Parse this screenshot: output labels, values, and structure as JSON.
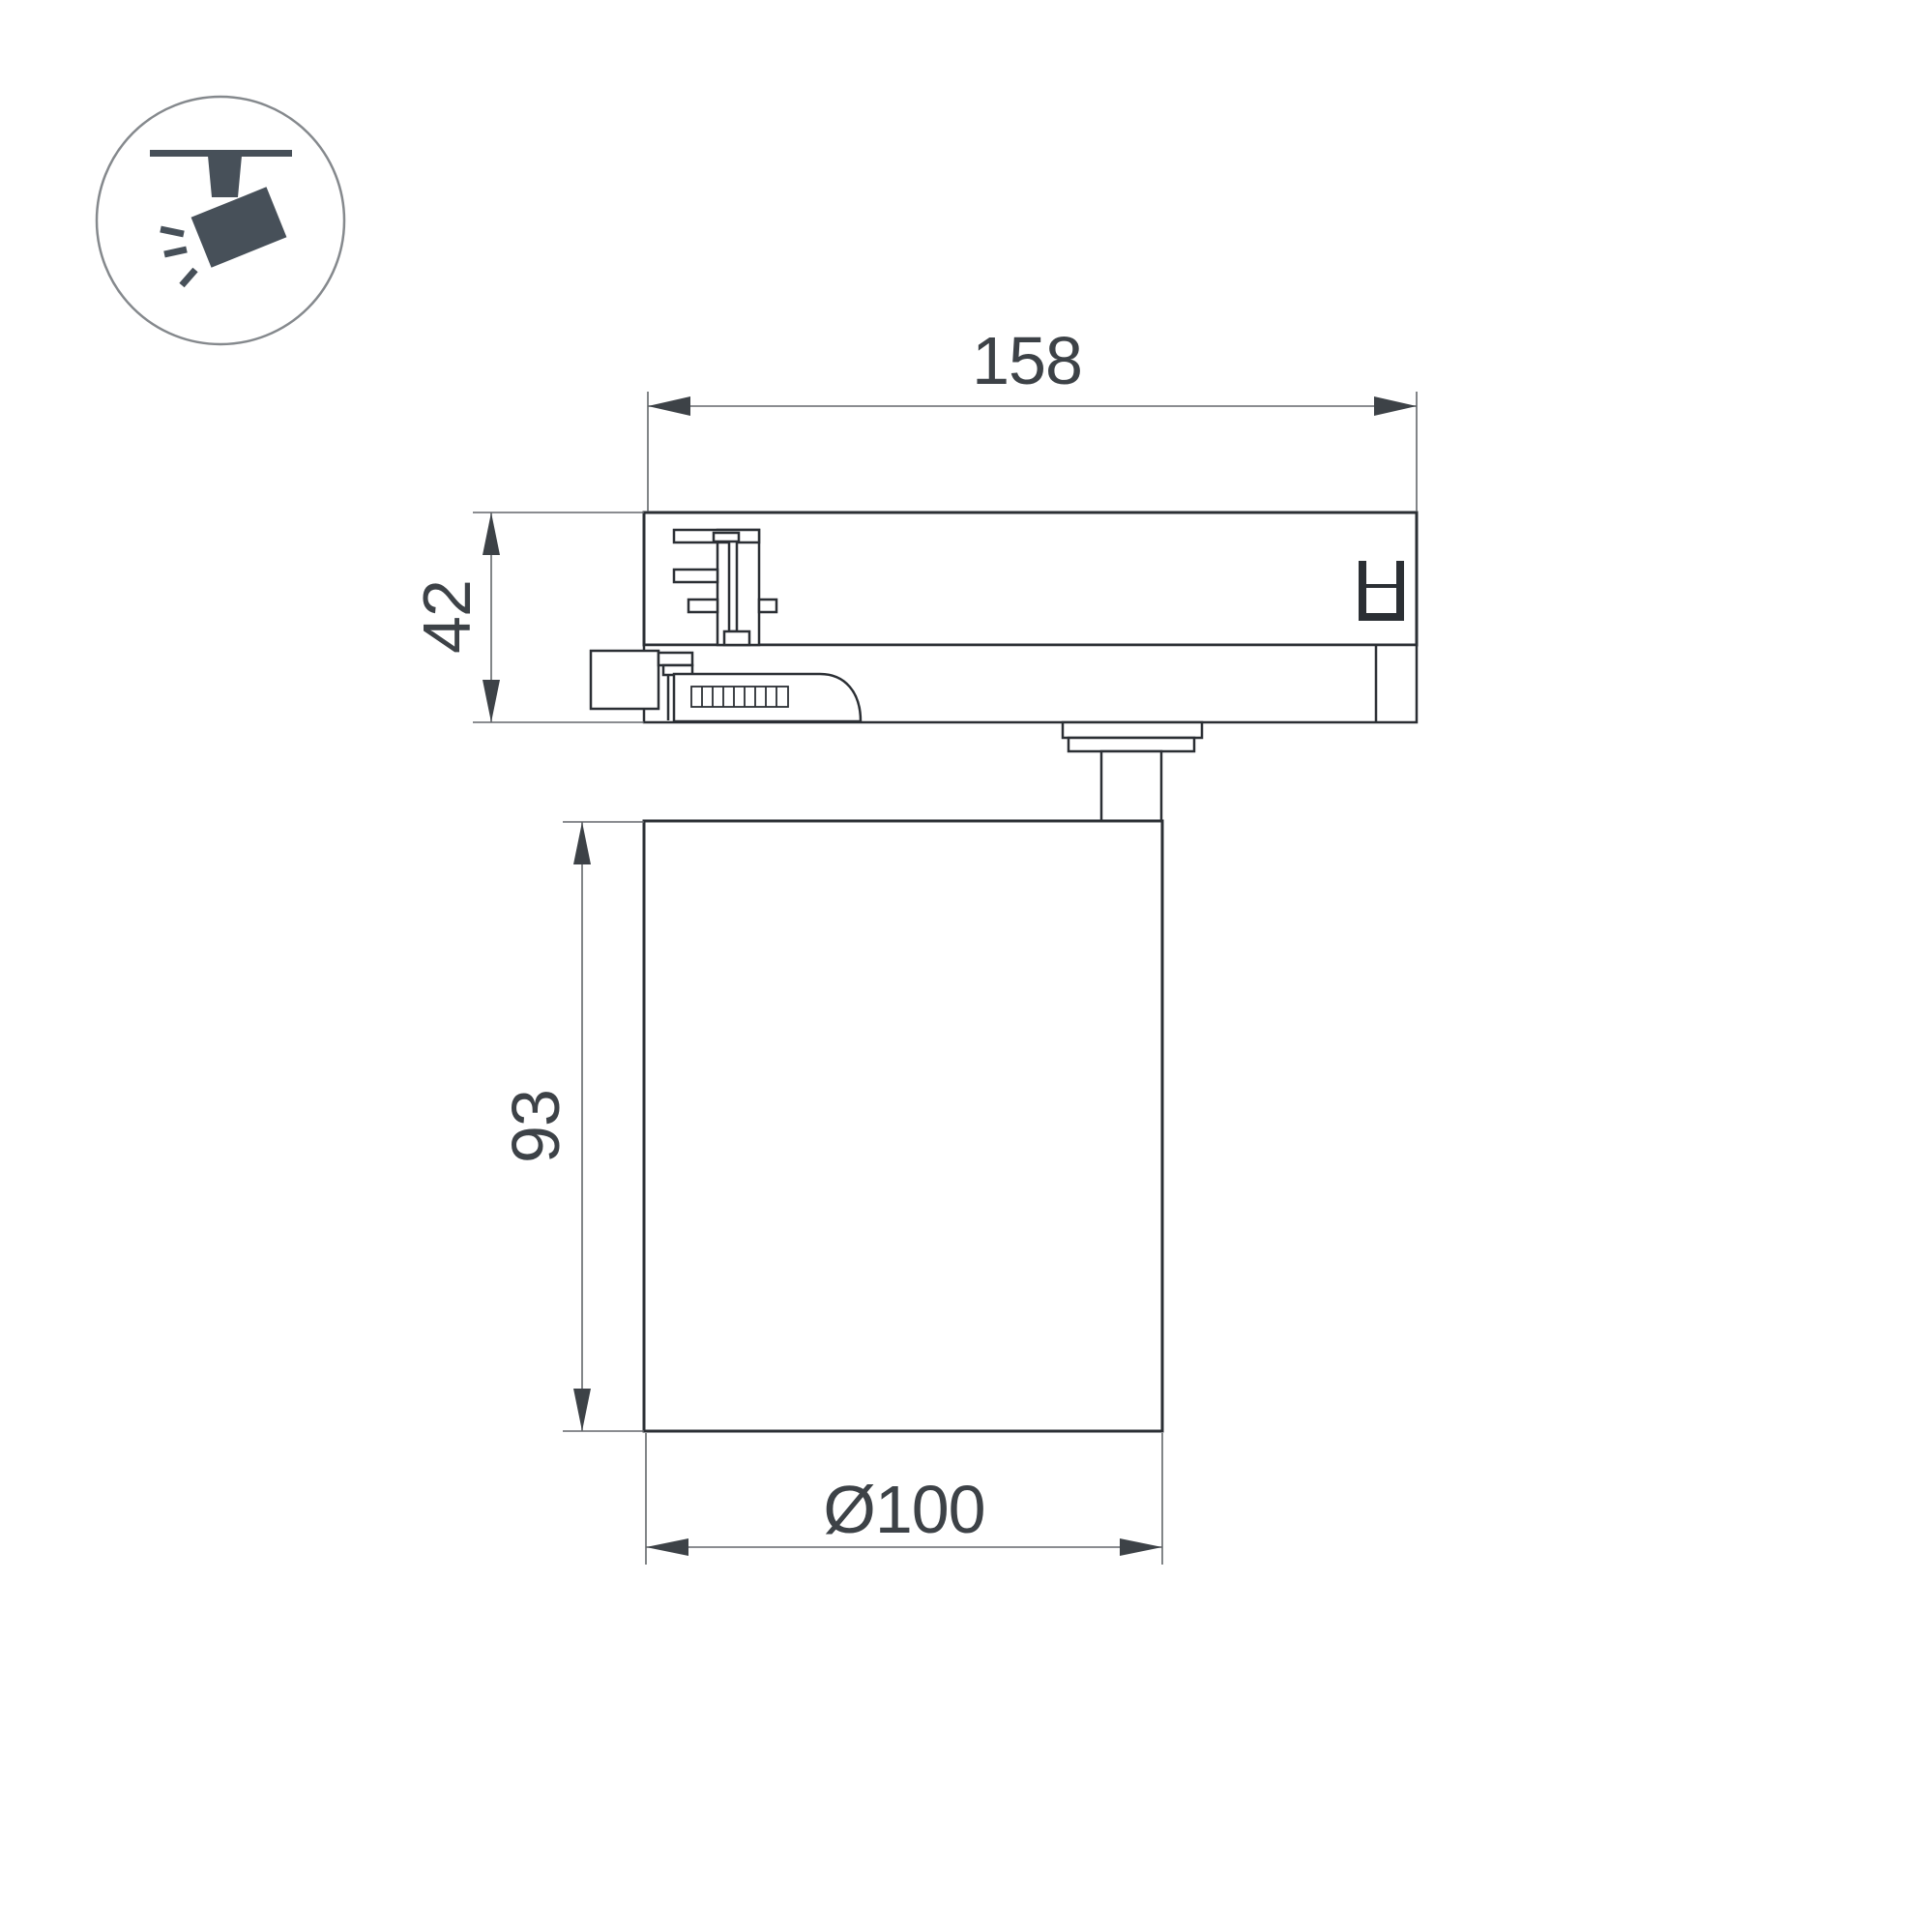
{
  "title": "track-light-fixture-dimension-drawing",
  "icon": {
    "name": "track-spotlight-icon",
    "color": "#475059",
    "circle_stroke": "#85898d"
  },
  "dimensions": {
    "width_top": "158",
    "adapter_height": "42",
    "body_height": "93",
    "body_diameter": "Ø100"
  },
  "colors": {
    "background": "#ffffff",
    "outline": "#2b2f34",
    "dim_line": "#63676b",
    "dim_text": "#3d4247",
    "arrow": "#3d4247"
  }
}
